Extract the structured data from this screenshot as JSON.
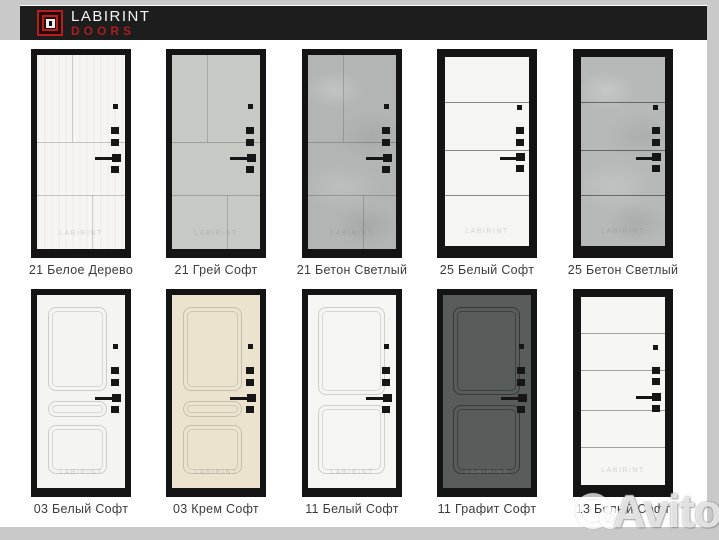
{
  "page": {
    "background": "#c9c9c9",
    "surface": "#ffffff"
  },
  "header": {
    "bar_color": "#1d1d1d",
    "logo_icon": "labirint-keyhole-logo",
    "brand_line1": "LABIRINT",
    "brand_line2": "DOORS",
    "brand_color_primary": "#f5f5f5",
    "brand_color_secondary": "#a91f1f"
  },
  "watermark": {
    "door_label": "LABIRINT",
    "photo_service": "Avito",
    "logo_icon": "avito-circles-logo"
  },
  "doors": [
    {
      "label": "21 Белое Дерево",
      "model": "21",
      "finish": "Белое Дерево",
      "panel_color": "#f6f5f3"
    },
    {
      "label": "21 Грей Софт",
      "model": "21",
      "finish": "Грей Софт",
      "panel_color": "#c7c9c5"
    },
    {
      "label": "21 Бетон Светлый",
      "model": "21",
      "finish": "Бетон Светлый",
      "panel_color": "#b3b5b4"
    },
    {
      "label": "25 Белый Софт",
      "model": "25",
      "finish": "Белый Софт",
      "panel_color": "#f5f6f4"
    },
    {
      "label": "25 Бетон Светлый",
      "model": "25",
      "finish": "Бетон Светлый",
      "panel_color": "#b7b9b8"
    },
    {
      "label": "03 Белый Софт",
      "model": "03",
      "finish": "Белый Софт",
      "panel_color": "#f4f4f2"
    },
    {
      "label": "03 Крем Софт",
      "model": "03",
      "finish": "Крем Софт",
      "panel_color": "#ece3cf"
    },
    {
      "label": "11 Белый Софт",
      "model": "11",
      "finish": "Белый Софт",
      "panel_color": "#f5f5f3"
    },
    {
      "label": "11 Графит Софт",
      "model": "11",
      "finish": "Графит Софт",
      "panel_color": "#585c5a"
    },
    {
      "label": "13 Белый Софт",
      "model": "13",
      "finish": "Белый Софт",
      "panel_color": "#f6f6f4"
    }
  ]
}
